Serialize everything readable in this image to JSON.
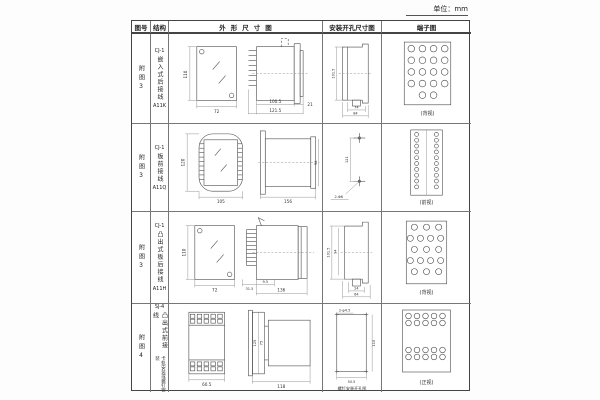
{
  "unit_label": "单位：mm",
  "table": {
    "headers": [
      "图号",
      "结构",
      "外形尺寸图",
      "安装开孔尺寸图",
      "端子图"
    ],
    "rows": [
      {
        "fig_no": "附图3",
        "structure": {
          "model": "CJ-1",
          "type": "嵌入式后接线",
          "code": "A11K"
        },
        "outline": {
          "front_h": "110",
          "front_w": "72",
          "d1": "100.5",
          "d2": "121.5",
          "d3": "21"
        },
        "install": {
          "v1": "101.5",
          "w1": "74",
          "w2": "84"
        },
        "terminal": {
          "view": "(背视)"
        }
      },
      {
        "fig_no": "附图3",
        "structure": {
          "model": "CJ-1",
          "type": "板前接线",
          "code": "A11Q"
        },
        "outline": {
          "front_h": "120",
          "front_w": "105",
          "d1": "156",
          "d2": "54"
        },
        "install": {
          "v1": "121",
          "hole": "2-Φ6"
        },
        "terminal": {
          "view": "(前视)"
        }
      },
      {
        "fig_no": "附图3",
        "structure": {
          "model": "CJ-1",
          "type": "凸出式板后接线",
          "code": "A11H"
        },
        "outline": {
          "front_h": "110",
          "front_w": "72",
          "d1": "31.5",
          "d2": "9.5",
          "d3": "136"
        },
        "install": {
          "v1": "101.5",
          "v2": "94",
          "w1": "24",
          "w2": "64"
        },
        "terminal": {
          "view": "(背视)"
        }
      },
      {
        "fig_no": "附图4",
        "structure": {
          "model": "SJ-4",
          "type": "凸出式前接线",
          "note": "卡轨安装或螺钉安装"
        },
        "outline": {
          "front_w": "60.5",
          "d1": "125",
          "d2": "75",
          "d3": "118"
        },
        "install": {
          "hole": "2-φ4.5",
          "v1": "110",
          "w1": "50.5",
          "caption": "螺钉安装开孔图"
        },
        "terminal": {
          "view": "(正视)"
        }
      }
    ]
  }
}
